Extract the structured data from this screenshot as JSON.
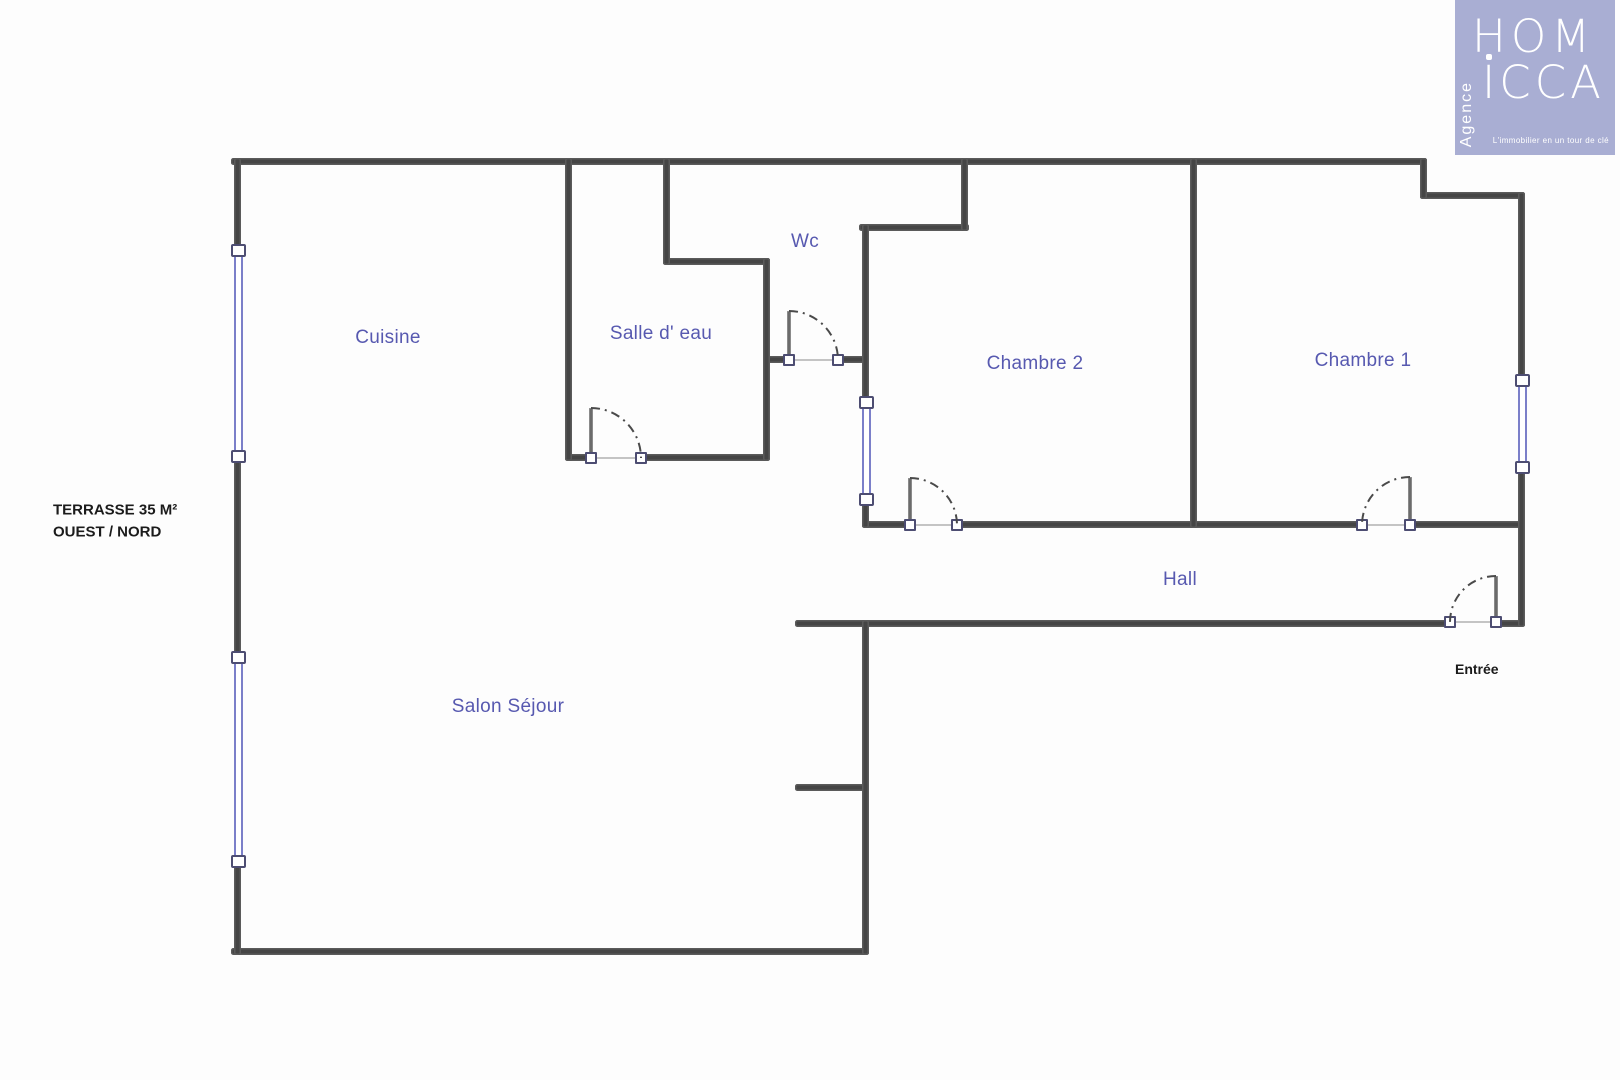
{
  "logo": {
    "brand_top": "HOM",
    "brand_bottom": "ICCA",
    "vertical_text": "Agence",
    "tagline": "L'immobilier en un tour de clé",
    "bg_color": "#a9aed3",
    "text_color": "#ffffff"
  },
  "plan": {
    "colors": {
      "wall": "#454545",
      "room_label": "#5759b0",
      "note_label": "#1b1b1b",
      "window_frame": "#7b7fc9",
      "arc": "#4a4a4a"
    },
    "labels": [
      {
        "id": "cuisine",
        "text": "Cuisine",
        "x": 388,
        "y": 338,
        "style": "room",
        "size": 19
      },
      {
        "id": "salle-deau",
        "text": "Salle d' eau",
        "x": 661,
        "y": 334,
        "style": "room",
        "size": 19
      },
      {
        "id": "wc",
        "text": "Wc",
        "x": 805,
        "y": 242,
        "style": "room",
        "size": 19
      },
      {
        "id": "chambre-2",
        "text": "Chambre 2",
        "x": 1035,
        "y": 364,
        "style": "room",
        "size": 19
      },
      {
        "id": "chambre-1",
        "text": "Chambre 1",
        "x": 1363,
        "y": 361,
        "style": "room",
        "size": 19
      },
      {
        "id": "hall",
        "text": "Hall",
        "x": 1180,
        "y": 580,
        "style": "room",
        "size": 19
      },
      {
        "id": "salon",
        "text": "Salon Séjour",
        "x": 508,
        "y": 707,
        "style": "room",
        "size": 19
      },
      {
        "id": "entree",
        "text": "Entrée",
        "x": 1455,
        "y": 669,
        "style": "note",
        "size": 14
      },
      {
        "id": "terrasse-1",
        "text": "TERRASSE 35 M²",
        "x": 53,
        "y": 510,
        "style": "note",
        "size": 15
      },
      {
        "id": "terrasse-2",
        "text": "OUEST / NORD",
        "x": 53,
        "y": 532,
        "style": "note",
        "size": 15
      }
    ],
    "walls": [
      {
        "id": "top",
        "x": 231,
        "y": 158,
        "w": 1196,
        "h": 7
      },
      {
        "id": "step-top",
        "x": 1420,
        "y": 192,
        "w": 105,
        "h": 7
      },
      {
        "id": "wc-notch-bottom",
        "x": 663,
        "y": 258,
        "w": 107,
        "h": 7
      },
      {
        "id": "chambre2-notch",
        "x": 859,
        "y": 224,
        "w": 110,
        "h": 7
      },
      {
        "id": "wc-bottom-left",
        "x": 763,
        "y": 356,
        "w": 30,
        "h": 7
      },
      {
        "id": "wc-bottom-right",
        "x": 835,
        "y": 356,
        "w": 34,
        "h": 7
      },
      {
        "id": "sde-bottom-left",
        "x": 565,
        "y": 454,
        "w": 30,
        "h": 7
      },
      {
        "id": "sde-bottom-right",
        "x": 639,
        "y": 454,
        "w": 131,
        "h": 7
      },
      {
        "id": "chambres-bottom-1",
        "x": 862,
        "y": 521,
        "w": 50,
        "h": 7
      },
      {
        "id": "chambres-bottom-2",
        "x": 955,
        "y": 521,
        "w": 409,
        "h": 7
      },
      {
        "id": "chambres-bottom-3",
        "x": 1406,
        "y": 521,
        "w": 119,
        "h": 7
      },
      {
        "id": "hall-bottom-left",
        "x": 795,
        "y": 620,
        "w": 657,
        "h": 7
      },
      {
        "id": "hall-bottom-right",
        "x": 1494,
        "y": 620,
        "w": 31,
        "h": 7
      },
      {
        "id": "salon-stub",
        "x": 795,
        "y": 784,
        "w": 74,
        "h": 7
      },
      {
        "id": "bottom",
        "x": 231,
        "y": 948,
        "w": 638,
        "h": 7
      },
      {
        "id": "left-top",
        "x": 234,
        "y": 158,
        "w": 7,
        "h": 90
      },
      {
        "id": "left-mid",
        "x": 234,
        "y": 459,
        "w": 7,
        "h": 196
      },
      {
        "id": "left-bottom",
        "x": 234,
        "y": 864,
        "w": 7,
        "h": 91
      },
      {
        "id": "sde-left",
        "x": 565,
        "y": 158,
        "w": 7,
        "h": 303
      },
      {
        "id": "wc-notch-left",
        "x": 663,
        "y": 158,
        "w": 7,
        "h": 107
      },
      {
        "id": "sde-right",
        "x": 763,
        "y": 258,
        "w": 7,
        "h": 203
      },
      {
        "id": "chambre2-left-top",
        "x": 862,
        "y": 224,
        "w": 7,
        "h": 176
      },
      {
        "id": "chambre2-left-bot",
        "x": 862,
        "y": 502,
        "w": 7,
        "h": 26
      },
      {
        "id": "chambre2-notch-v",
        "x": 961,
        "y": 158,
        "w": 7,
        "h": 73
      },
      {
        "id": "chambres-divider",
        "x": 1190,
        "y": 158,
        "w": 7,
        "h": 370
      },
      {
        "id": "salon-right",
        "x": 862,
        "y": 620,
        "w": 7,
        "h": 335
      },
      {
        "id": "step-right-v",
        "x": 1420,
        "y": 158,
        "w": 7,
        "h": 41
      },
      {
        "id": "right-top",
        "x": 1518,
        "y": 192,
        "w": 7,
        "h": 186
      },
      {
        "id": "right-bottom",
        "x": 1518,
        "y": 470,
        "w": 7,
        "h": 157
      }
    ],
    "windows": [
      {
        "id": "terrace-window-north",
        "x": 238,
        "y1": 245,
        "y2": 462
      },
      {
        "id": "terrace-window-south",
        "x": 238,
        "y1": 652,
        "y2": 867
      },
      {
        "id": "chambre2-inner-window",
        "x": 866,
        "y1": 397,
        "y2": 505
      },
      {
        "id": "chambre1-window",
        "x": 1522,
        "y1": 375,
        "y2": 473
      }
    ],
    "doors": [
      {
        "id": "salle-deau-door",
        "hx": 591,
        "hy": 458,
        "w": 50,
        "dir": 1
      },
      {
        "id": "wc-door",
        "hx": 789,
        "hy": 360,
        "w": 49,
        "dir": 1
      },
      {
        "id": "chambre2-door",
        "hx": 910,
        "hy": 525,
        "w": 47,
        "dir": 1
      },
      {
        "id": "chambre1-door",
        "hx": 1410,
        "hy": 525,
        "w": 48,
        "dir": -1
      },
      {
        "id": "entree-door",
        "hx": 1496,
        "hy": 622,
        "w": 46,
        "dir": -1
      }
    ]
  }
}
